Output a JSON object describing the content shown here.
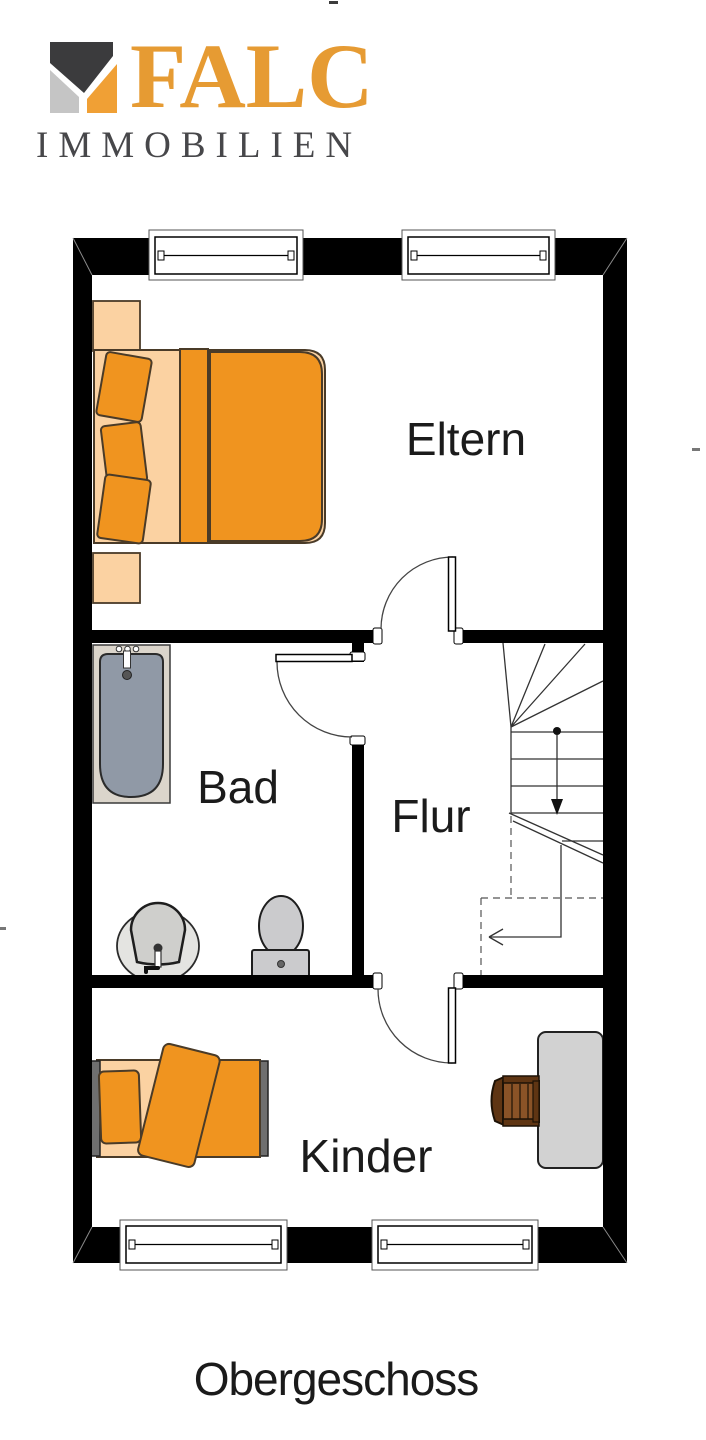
{
  "brand": {
    "name": "FALC",
    "subtitle": "IMMOBILIEN",
    "logo_colors": {
      "roof": "#3B3B3D",
      "left_wall": "#C5C5C5",
      "right_wall": "#F0A035",
      "wordmark": "#E69B33",
      "subtitle_text": "#47474A"
    }
  },
  "plan": {
    "rooms": [
      {
        "id": "eltern",
        "label": "Eltern",
        "furniture": [
          "double-bed",
          "nightstand",
          "nightstand"
        ]
      },
      {
        "id": "bad",
        "label": "Bad",
        "furniture": [
          "bathtub",
          "sink",
          "toilet"
        ]
      },
      {
        "id": "flur",
        "label": "Flur",
        "furniture": [
          "staircase"
        ]
      },
      {
        "id": "kinder",
        "label": "Kinder",
        "furniture": [
          "single-bed",
          "desk",
          "chair"
        ]
      }
    ],
    "window_count": 4,
    "door_count": 3,
    "colors": {
      "wall": "#000000",
      "furniture_orange": "#F0941F",
      "furniture_peach": "#FBD2A2",
      "tub_gray": "#9099A6",
      "fixture_gray": "#CBCBCD",
      "desk_gray": "#D2D2D2",
      "chair_wood": "#8A5327",
      "label_text": "#1B1B1B"
    }
  },
  "floor_title": "Obergeschoss"
}
